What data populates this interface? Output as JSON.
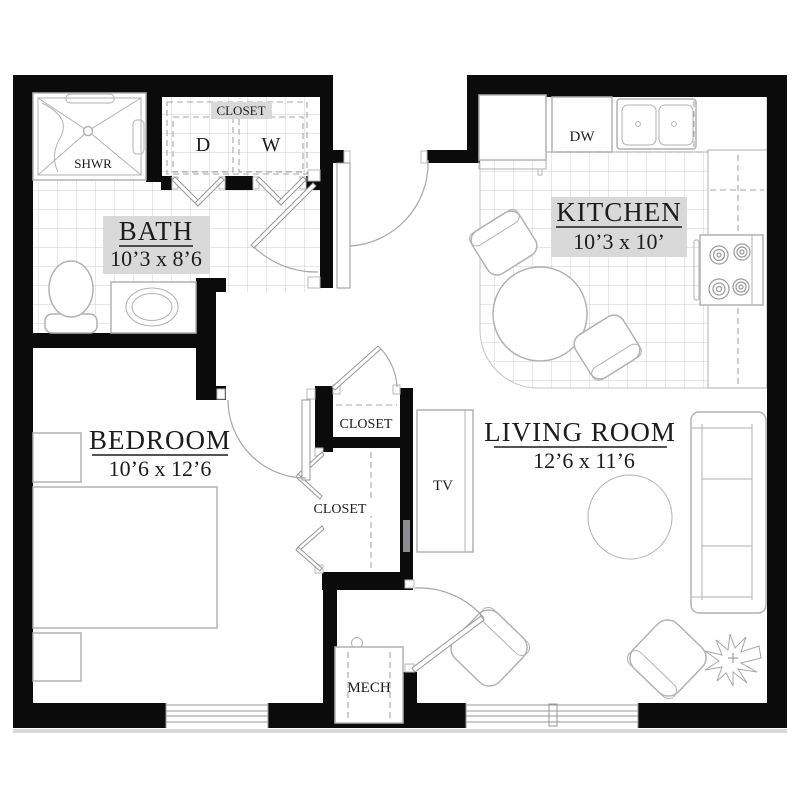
{
  "title": "One-bedroom apartment floor plan",
  "colors": {
    "wall": "#0b0b0b",
    "furniture_line": "#b2b2b6",
    "tile_line": "#cfcfd2",
    "text": "#1c1c1e",
    "label_background": "#d9d9d9"
  },
  "rooms": {
    "bath": {
      "name": "BATH",
      "dims": "10’3 x 8’6"
    },
    "kitchen": {
      "name": "KITCHEN",
      "dims": "10’3 x 10’"
    },
    "bedroom": {
      "name": "BEDROOM",
      "dims": "10’6 x 12’6"
    },
    "living_room": {
      "name": "LIVING ROOM",
      "dims": "12’6 x 11’6"
    }
  },
  "labels": {
    "laundry_closet": "CLOSET",
    "dryer": "D",
    "washer": "W",
    "shower": "SHWR",
    "dishwasher": "DW",
    "hall_closet_upper": "CLOSET",
    "hall_closet_lower": "CLOSET",
    "tv": "TV",
    "mechanical": "MECH"
  }
}
